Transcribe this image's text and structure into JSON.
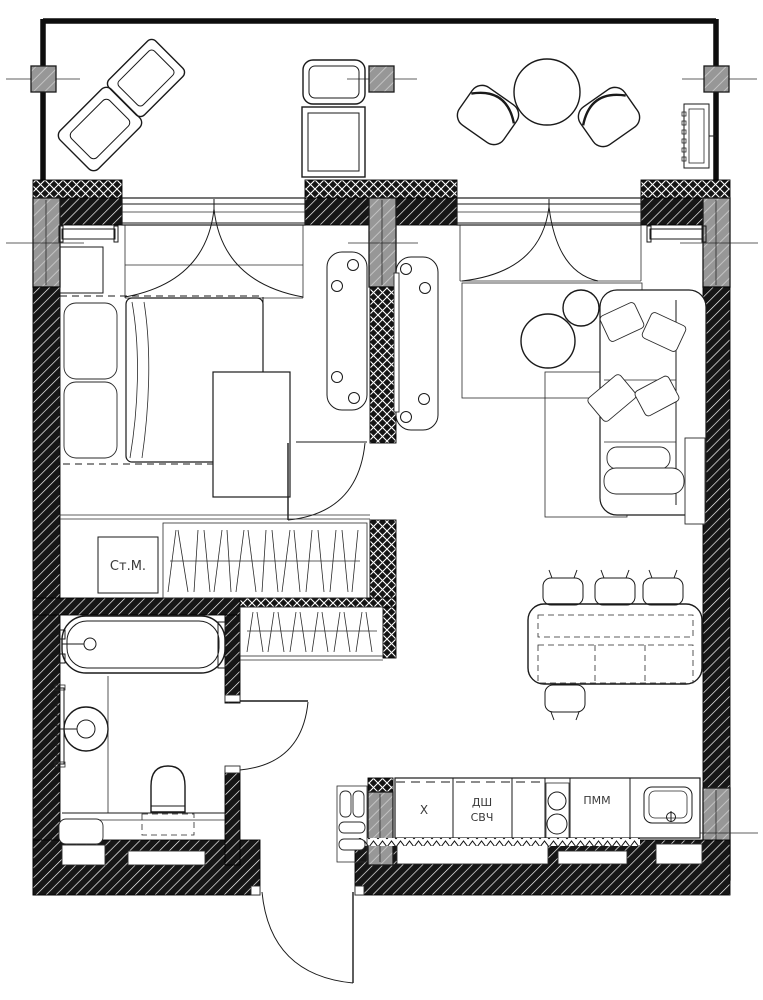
{
  "document": {
    "type": "apartment floor plan",
    "style": "monochrome architectural drawing"
  },
  "colors": {
    "ink": "#1a1a1a",
    "wall_fill": "#141414",
    "column_fill": "#949494",
    "paper": "#ffffff"
  },
  "labels": {
    "washing_machine": "Ст.М.",
    "fridge": "Х",
    "oven": "ДШ",
    "microwave": "СВЧ",
    "dishwasher": "ПММ"
  }
}
